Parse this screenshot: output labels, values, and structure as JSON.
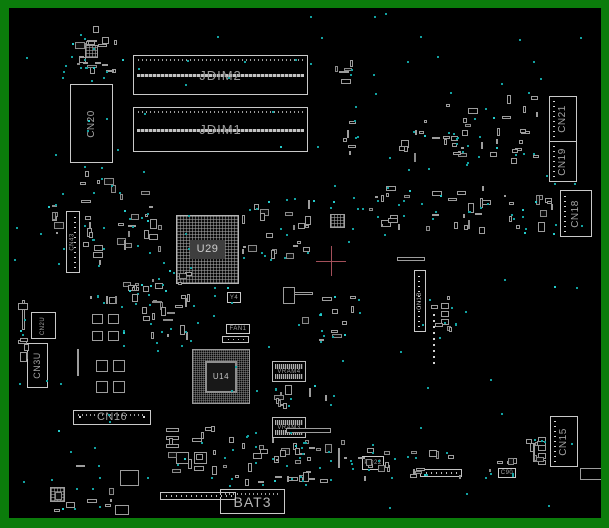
{
  "board": {
    "width": 609,
    "height": 528,
    "frame_color": "#0b7c0b",
    "background": "#000000",
    "outline_color": "#c9c9c9",
    "testpoint_color": "#12a2a2",
    "crosshair": {
      "x": 331,
      "y": 261,
      "arm": 15,
      "color": "#a4505a"
    },
    "connectors": [
      {
        "name": "jdim2",
        "label": "JDIM2",
        "type": "dimm",
        "x": 133,
        "y": 55,
        "w": 175,
        "h": 40
      },
      {
        "name": "jdim1",
        "label": "JDIM1",
        "type": "dimm",
        "x": 133,
        "y": 107,
        "w": 175,
        "h": 45
      },
      {
        "name": "cn20",
        "label": "CN20",
        "type": "vconn",
        "x": 70,
        "y": 84,
        "w": 43,
        "h": 79
      },
      {
        "name": "cn43",
        "label": "CN43",
        "type": "vconn-sm",
        "pins": "right",
        "x": 66,
        "y": 211,
        "w": 14,
        "h": 62
      },
      {
        "name": "cn2u",
        "label": "CN2U",
        "type": "vconn-sm",
        "x": 31,
        "y": 312,
        "w": 25,
        "h": 27
      },
      {
        "name": "cn3u",
        "label": "CN3U",
        "type": "vconn",
        "x": 27,
        "y": 343,
        "w": 21,
        "h": 45
      },
      {
        "name": "u29",
        "label": "U29",
        "type": "bga",
        "x": 176,
        "y": 215,
        "w": 63,
        "h": 69
      },
      {
        "name": "u14",
        "label": "U14",
        "type": "bga2",
        "x": 192,
        "y": 349,
        "w": 58,
        "h": 55
      },
      {
        "name": "y4",
        "label": "Y4",
        "type": "tiny",
        "x": 227,
        "y": 292,
        "w": 14,
        "h": 11
      },
      {
        "name": "fan1",
        "label": "FAN1",
        "type": "tiny",
        "x": 226,
        "y": 324,
        "w": 24,
        "h": 10
      },
      {
        "name": "vram4",
        "label": "VRAM4",
        "type": "vram",
        "x": 272,
        "y": 361,
        "w": 34,
        "h": 21
      },
      {
        "name": "vram3",
        "label": "VRAM3",
        "type": "vram",
        "x": 272,
        "y": 417,
        "w": 34,
        "h": 21
      },
      {
        "name": "cn16",
        "label": "CN16",
        "type": "hconn",
        "x": 73,
        "y": 410,
        "w": 78,
        "h": 15
      },
      {
        "name": "cn1b",
        "label": "CN1B",
        "type": "vconn-sm",
        "pins": "left",
        "x": 414,
        "y": 270,
        "w": 12,
        "h": 62
      },
      {
        "name": "cn21",
        "label": "CN21",
        "type": "vconn",
        "pins": "left",
        "x": 549,
        "y": 96,
        "w": 28,
        "h": 46
      },
      {
        "name": "cn19",
        "label": "CN19",
        "type": "vconn",
        "pins": "left",
        "x": 549,
        "y": 141,
        "w": 28,
        "h": 41
      },
      {
        "name": "cn18",
        "label": "CN18",
        "type": "vconn",
        "pins": "left",
        "x": 560,
        "y": 190,
        "w": 32,
        "h": 47
      },
      {
        "name": "cn15",
        "label": "CN15",
        "type": "vconn",
        "pins": "left",
        "x": 550,
        "y": 416,
        "w": 28,
        "h": 51
      },
      {
        "name": "bat3",
        "label": "BAT3",
        "type": "bat",
        "x": 220,
        "y": 489,
        "w": 65,
        "h": 25
      },
      {
        "name": "po22",
        "label": "PO22",
        "type": "tiny",
        "x": 362,
        "y": 456,
        "w": 22,
        "h": 14
      },
      {
        "name": "c90",
        "label": "C90",
        "type": "tiny",
        "x": 498,
        "y": 468,
        "w": 18,
        "h": 10
      }
    ],
    "parts": [
      [
        92,
        314,
        11,
        10
      ],
      [
        108,
        314,
        11,
        10
      ],
      [
        92,
        331,
        11,
        10
      ],
      [
        108,
        331,
        11,
        10
      ],
      [
        96,
        360,
        12,
        12
      ],
      [
        113,
        360,
        12,
        12
      ],
      [
        96,
        381,
        12,
        12
      ],
      [
        113,
        381,
        12,
        12
      ],
      [
        85,
        45,
        13,
        13,
        "mesh"
      ],
      [
        330,
        214,
        15,
        14,
        "mesh"
      ],
      [
        50,
        487,
        15,
        15,
        "mesh"
      ],
      [
        120,
        470,
        19,
        16
      ],
      [
        166,
        428,
        13,
        4
      ],
      [
        166,
        436,
        13,
        4
      ],
      [
        166,
        444,
        13,
        4
      ],
      [
        176,
        452,
        13,
        12
      ],
      [
        194,
        452,
        13,
        12
      ],
      [
        286,
        428,
        45,
        5
      ],
      [
        293,
        292,
        20,
        3
      ],
      [
        283,
        287,
        12,
        17
      ],
      [
        338,
        448,
        2,
        20
      ],
      [
        533,
        443,
        2,
        19
      ],
      [
        22,
        300,
        3,
        30
      ],
      [
        77,
        349,
        2,
        27
      ],
      [
        397,
        257,
        28,
        4
      ],
      [
        538,
        437,
        8,
        6
      ],
      [
        538,
        445,
        8,
        6
      ],
      [
        538,
        453,
        8,
        6
      ],
      [
        538,
        460,
        8,
        5
      ],
      [
        441,
        303,
        8,
        6
      ],
      [
        441,
        311,
        8,
        6
      ],
      [
        441,
        319,
        8,
        6
      ],
      [
        497,
        461,
        6,
        3
      ],
      [
        507,
        461,
        6,
        3
      ],
      [
        580,
        468,
        22,
        12
      ],
      [
        115,
        505,
        14,
        10
      ],
      [
        54,
        509,
        6,
        3
      ],
      [
        160,
        492,
        76,
        8,
        "pins"
      ],
      [
        420,
        469,
        42,
        8,
        "pins"
      ],
      [
        222,
        336,
        27,
        7,
        "pins"
      ],
      [
        79,
        416,
        2,
        2,
        "w"
      ],
      [
        143,
        416,
        2,
        2,
        "w"
      ]
    ],
    "clusters": [
      [
        62,
        25,
        58,
        54,
        20,
        10,
        1
      ],
      [
        78,
        166,
        40,
        38,
        6,
        5,
        2
      ],
      [
        52,
        172,
        14,
        92,
        7,
        4,
        3
      ],
      [
        82,
        212,
        22,
        58,
        8,
        5,
        4
      ],
      [
        112,
        190,
        52,
        74,
        16,
        9,
        5
      ],
      [
        88,
        282,
        62,
        28,
        8,
        6,
        6
      ],
      [
        148,
        266,
        48,
        44,
        12,
        8,
        7
      ],
      [
        18,
        298,
        12,
        92,
        7,
        4,
        8
      ],
      [
        242,
        196,
        72,
        64,
        20,
        12,
        9
      ],
      [
        335,
        55,
        24,
        104,
        10,
        6,
        10
      ],
      [
        396,
        120,
        78,
        48,
        14,
        8,
        11
      ],
      [
        440,
        92,
        106,
        74,
        24,
        12,
        12
      ],
      [
        360,
        186,
        88,
        52,
        14,
        9,
        13
      ],
      [
        448,
        186,
        78,
        50,
        16,
        9,
        14
      ],
      [
        534,
        182,
        22,
        54,
        7,
        4,
        15
      ],
      [
        430,
        292,
        26,
        46,
        5,
        5,
        16
      ],
      [
        296,
        296,
        62,
        48,
        9,
        7,
        17
      ],
      [
        273,
        385,
        62,
        28,
        9,
        7,
        18
      ],
      [
        273,
        440,
        62,
        26,
        9,
        6,
        19
      ],
      [
        165,
        426,
        92,
        52,
        16,
        9,
        20
      ],
      [
        340,
        440,
        52,
        44,
        10,
        7,
        21
      ],
      [
        385,
        450,
        80,
        30,
        10,
        7,
        22
      ],
      [
        45,
        452,
        96,
        58,
        7,
        7,
        23
      ],
      [
        215,
        474,
        92,
        13,
        7,
        4,
        24
      ],
      [
        488,
        456,
        34,
        22,
        3,
        3,
        25
      ],
      [
        524,
        434,
        24,
        32,
        6,
        3,
        26
      ],
      [
        252,
        438,
        54,
        28,
        8,
        5,
        27
      ],
      [
        300,
        466,
        40,
        18,
        5,
        4,
        28
      ],
      [
        120,
        282,
        60,
        70,
        6,
        8,
        29
      ],
      [
        150,
        306,
        45,
        40,
        8,
        6,
        30
      ]
    ],
    "pin_trail": {
      "x": 433,
      "y0": 314,
      "y1": 366,
      "step": 6
    },
    "global_dots": {
      "count": 120,
      "x": 14,
      "y": 12,
      "w": 577,
      "h": 498,
      "seed": 11
    }
  }
}
